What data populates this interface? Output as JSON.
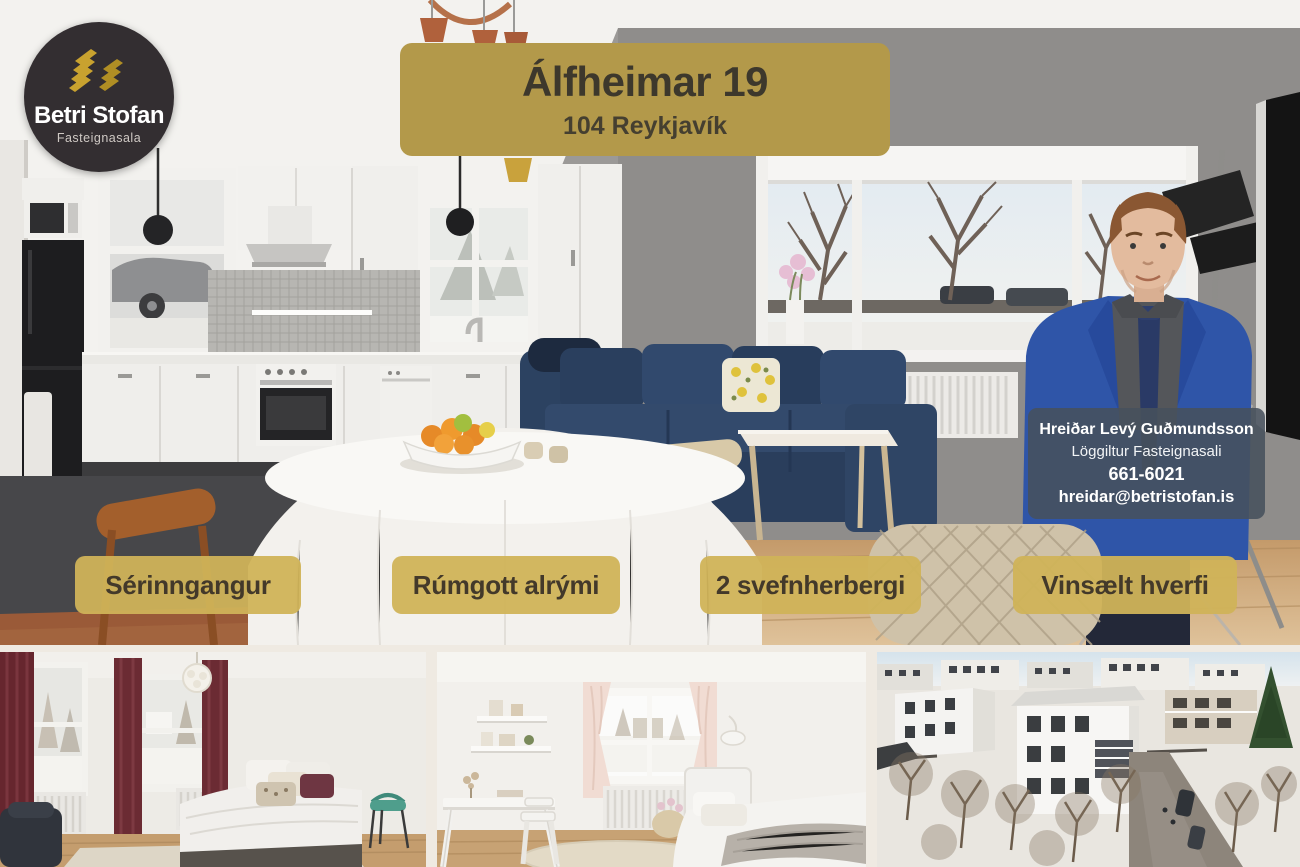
{
  "logo": {
    "name": "Betri Stofan",
    "subtitle": "Fasteignasala",
    "icon": "gold-buildings-chevrons"
  },
  "listing": {
    "title": "Álfheimar 19",
    "location": "104 Reykjavík"
  },
  "agent": {
    "name": "Hreiðar Levý Guðmundsson",
    "role": "Löggiltur Fasteignasali",
    "phone": "661-6021",
    "email": "hreidar@betristofan.is"
  },
  "features": [
    {
      "label": "Sérinngangur"
    },
    {
      "label": "Rúmgott alrými"
    },
    {
      "label": "2 svefnherbergi"
    },
    {
      "label": "Vinsælt hverfi"
    }
  ],
  "photo_labels": {
    "main": "Open-plan kitchen and living room with blue corner sofa, dining table and agent portrait",
    "bottom_left": "Master bedroom with dark red curtains",
    "bottom_middle": "Second bedroom in white with desk and single bed",
    "bottom_right": "Aerial winter view of white apartment building and neighbourhood"
  },
  "colors": {
    "title_badge": "#b3994a",
    "feature_badge": "#d0b358",
    "logo_background": "#332e31",
    "agent_box": "rgba(71,81,92,0.88)",
    "badge_text": "#43392a",
    "gap": "#efeae2"
  }
}
